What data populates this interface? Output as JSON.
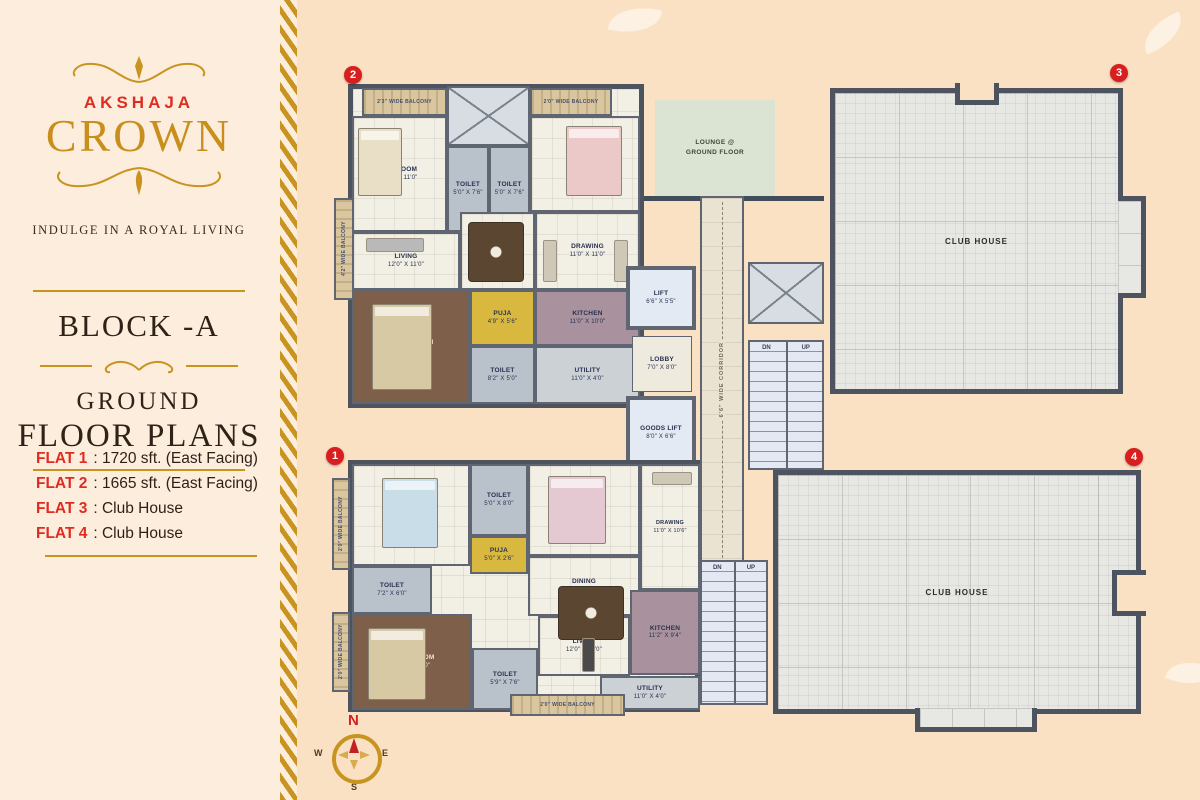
{
  "sidebar": {
    "brand": "AKSHAJA",
    "logo_title": "CROWN",
    "tagline": "INDULGE IN A ROYAL LIVING",
    "block_title": "BLOCK -A",
    "plans_line1": "GROUND",
    "plans_line2": "FLOOR PLANS",
    "flats": [
      {
        "label": "FLAT 1",
        "value": ": 1720 sft. (East Facing)"
      },
      {
        "label": "FLAT 2",
        "value": ": 1665 sft. (East Facing)"
      },
      {
        "label": "FLAT 3",
        "value": ": Club House"
      },
      {
        "label": "FLAT 4",
        "value": ": Club House"
      }
    ]
  },
  "plan": {
    "flat2": {
      "badge": "2",
      "balconies": {
        "top_left": "2'3\" WIDE BALCONY",
        "top_right": "2'0\" WIDE BALCONY",
        "left": "4'2\" WIDE BALCONY"
      },
      "rooms": {
        "bedroom1": {
          "name": "BEDROOM",
          "dims": "12'4\" X 11'0\""
        },
        "toilet1": {
          "name": "TOILET",
          "dims": "5'0\" X 7'6\""
        },
        "toilet2": {
          "name": "TOILET",
          "dims": "5'0\" X 7'6\""
        },
        "bedroom2": {
          "name": "BEDROOM",
          "dims": "11'0\" X 11'0\""
        },
        "living": {
          "name": "LIVING",
          "dims": "12'0\" X 11'0\""
        },
        "dining": {
          "name": "DINING",
          "dims": "9'4\" X 11'0\""
        },
        "drawing": {
          "name": "DRAWING",
          "dims": "11'0\" X 11'0\""
        },
        "m_bedroom": {
          "name": "M. BEDROOM",
          "dims": "14'6\" X 12'0\""
        },
        "puja": {
          "name": "PUJA",
          "dims": "4'9\" X 5'6\""
        },
        "toilet3": {
          "name": "TOILET",
          "dims": "8'2\" X 5'0\""
        },
        "kitchen": {
          "name": "KITCHEN",
          "dims": "11'0\" X 10'0\""
        },
        "utility": {
          "name": "UTILITY",
          "dims": "11'0\" X 4'0\""
        }
      }
    },
    "flat1": {
      "badge": "1",
      "balconies": {
        "left_top": "2'0\" WIDE BALCONY",
        "left_bottom": "2'0\" WIDE BALCONY",
        "bottom": "2'0\" WIDE BALCONY"
      },
      "rooms": {
        "bedroom1": {
          "name": "BEDROOM",
          "dims": "14'2\" X 11'2\""
        },
        "toilet1": {
          "name": "TOILET",
          "dims": "5'0\" X 8'0\""
        },
        "bedroom2": {
          "name": "BEDROOM",
          "dims": "12'0\" X 11'0\""
        },
        "drawing": {
          "name": "DRAWING",
          "dims": "11'0\" X 10'6\""
        },
        "puja": {
          "name": "PUJA",
          "dims": "5'0\" X 2'6\""
        },
        "toilet2": {
          "name": "TOILET",
          "dims": "7'2\" X 6'0\""
        },
        "dining": {
          "name": "DINING",
          "dims": "12'0\" X 10'0\""
        },
        "m_bedroom": {
          "name": "M. BEDROOM",
          "dims": "14'0\" X 12'0\""
        },
        "toilet3": {
          "name": "TOILET",
          "dims": "5'9\" X 7'6\""
        },
        "living": {
          "name": "LIVING",
          "dims": "12'0\" X 11'0\""
        },
        "kitchen": {
          "name": "KITCHEN",
          "dims": "11'2\" X 9'4\""
        },
        "utility": {
          "name": "UTILITY",
          "dims": "11'0\" X 4'0\""
        }
      }
    },
    "core": {
      "lift": {
        "name": "LIFT",
        "dims": "6'6\" X 5'5\""
      },
      "lobby": {
        "name": "LOBBY",
        "dims": "7'0\" X 8'0\""
      },
      "goods_lift": {
        "name": "GOODS LIFT",
        "dims": "8'0\" X 6'6\""
      },
      "corridor_label": "6'6\" WIDE CORRIDOR",
      "lounge_line1": "LOUNGE @",
      "lounge_line2": "GROUND FLOOR",
      "stairs_dn": "DN",
      "stairs_up": "UP"
    },
    "clubhouse3": {
      "badge": "3",
      "label": "CLUB HOUSE"
    },
    "clubhouse4": {
      "badge": "4",
      "label": "CLUB HOUSE"
    }
  },
  "compass": {
    "north": "N",
    "east": "E",
    "south": "S",
    "west": "W"
  },
  "colors": {
    "gold": "#c9931f",
    "brand_red": "#e02b20",
    "badge_red": "#d81e1e",
    "wall": "#4e545f"
  }
}
